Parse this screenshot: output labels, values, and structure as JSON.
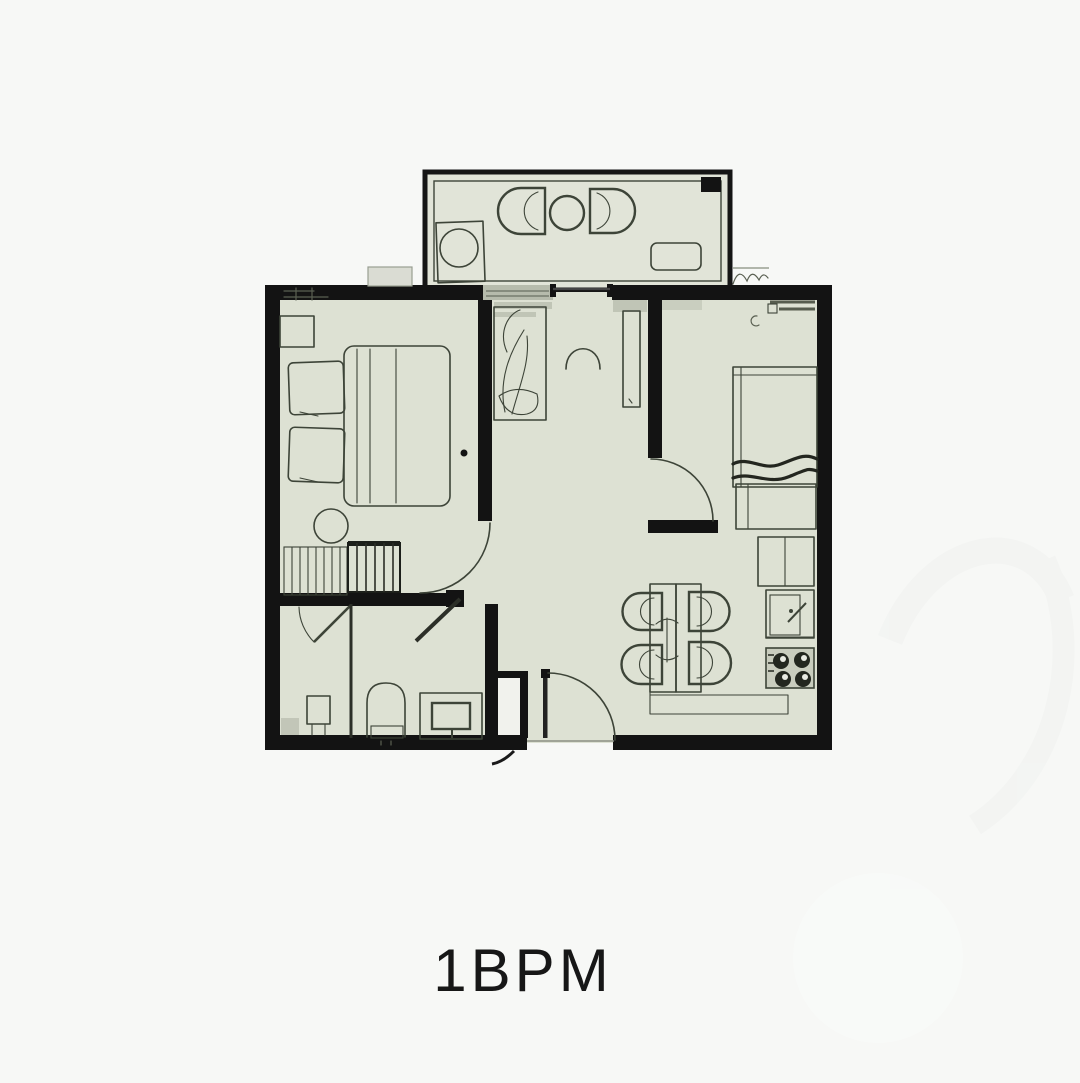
{
  "plan": {
    "label": "1BPM"
  },
  "colors": {
    "background": "#f7f8f6",
    "floor": "#dde1d3",
    "balcony_floor": "#e1e4d8",
    "wall": "#131313",
    "line": "#3d4438",
    "window_gray": "#b6bbac",
    "niche_floor": "#f1f2ed",
    "stove_fill": "#c9cdbe",
    "label_color": "#171717"
  }
}
